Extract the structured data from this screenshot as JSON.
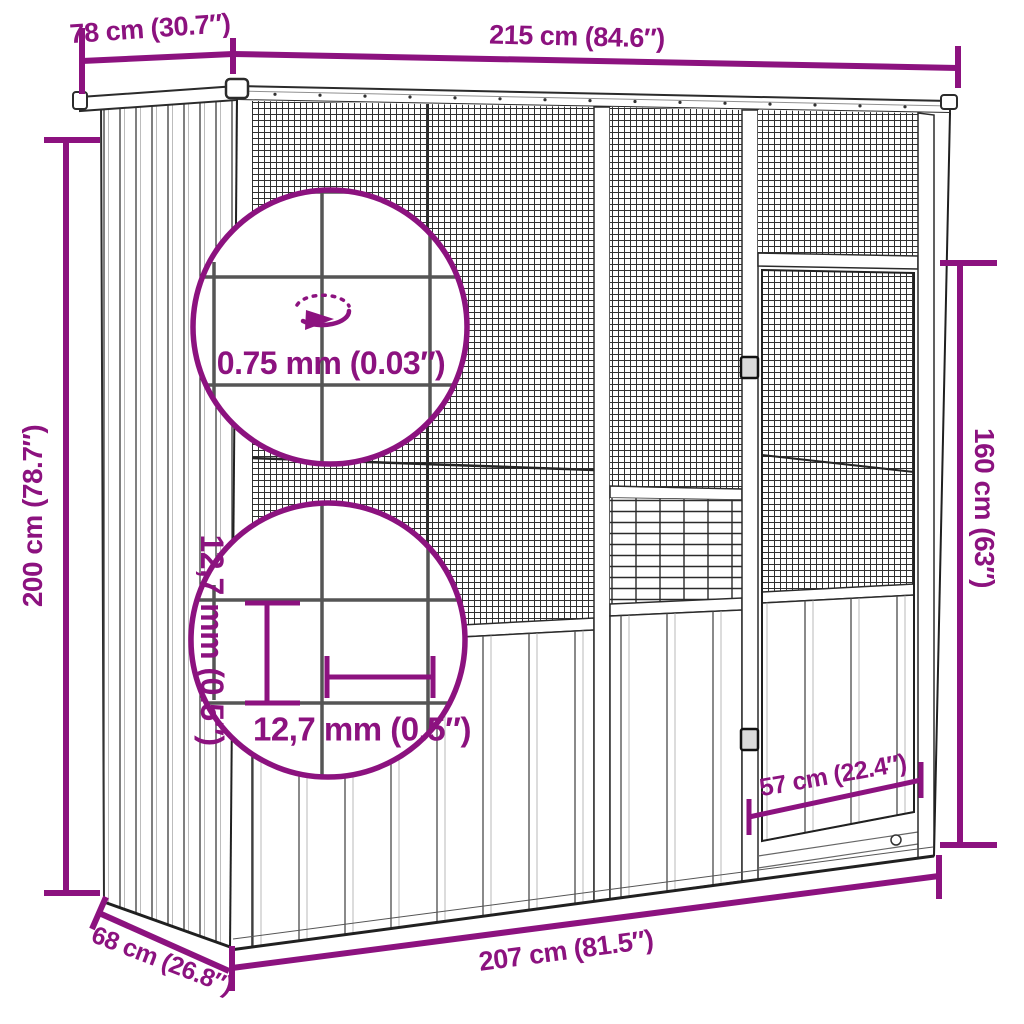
{
  "page": {
    "subject": "Outdoor bird aviary / cage technical dimension drawing",
    "background_color": "#ffffff"
  },
  "colors": {
    "dimension_accent": "#8C127F",
    "line_art": "#222222",
    "background": "#ffffff"
  },
  "dimensions": {
    "roof_depth": "78 cm (30.7″)",
    "roof_width": "215 cm (84.6″)",
    "total_height": "200 cm (78.7″)",
    "door_height": "160 cm (63″)",
    "wire_diameter": "0.75 mm (0.03″)",
    "mesh_spacing_vertical": "12,7 mm (0.5″)",
    "mesh_spacing_horizontal": "12,7 mm (0.5″)",
    "door_width": "57 cm (22.4″)",
    "base_width": "207 cm (81.5″)",
    "base_depth": "68 cm (26.8″)"
  },
  "icons": {
    "rotation": "rotation-ellipse-arrow"
  }
}
